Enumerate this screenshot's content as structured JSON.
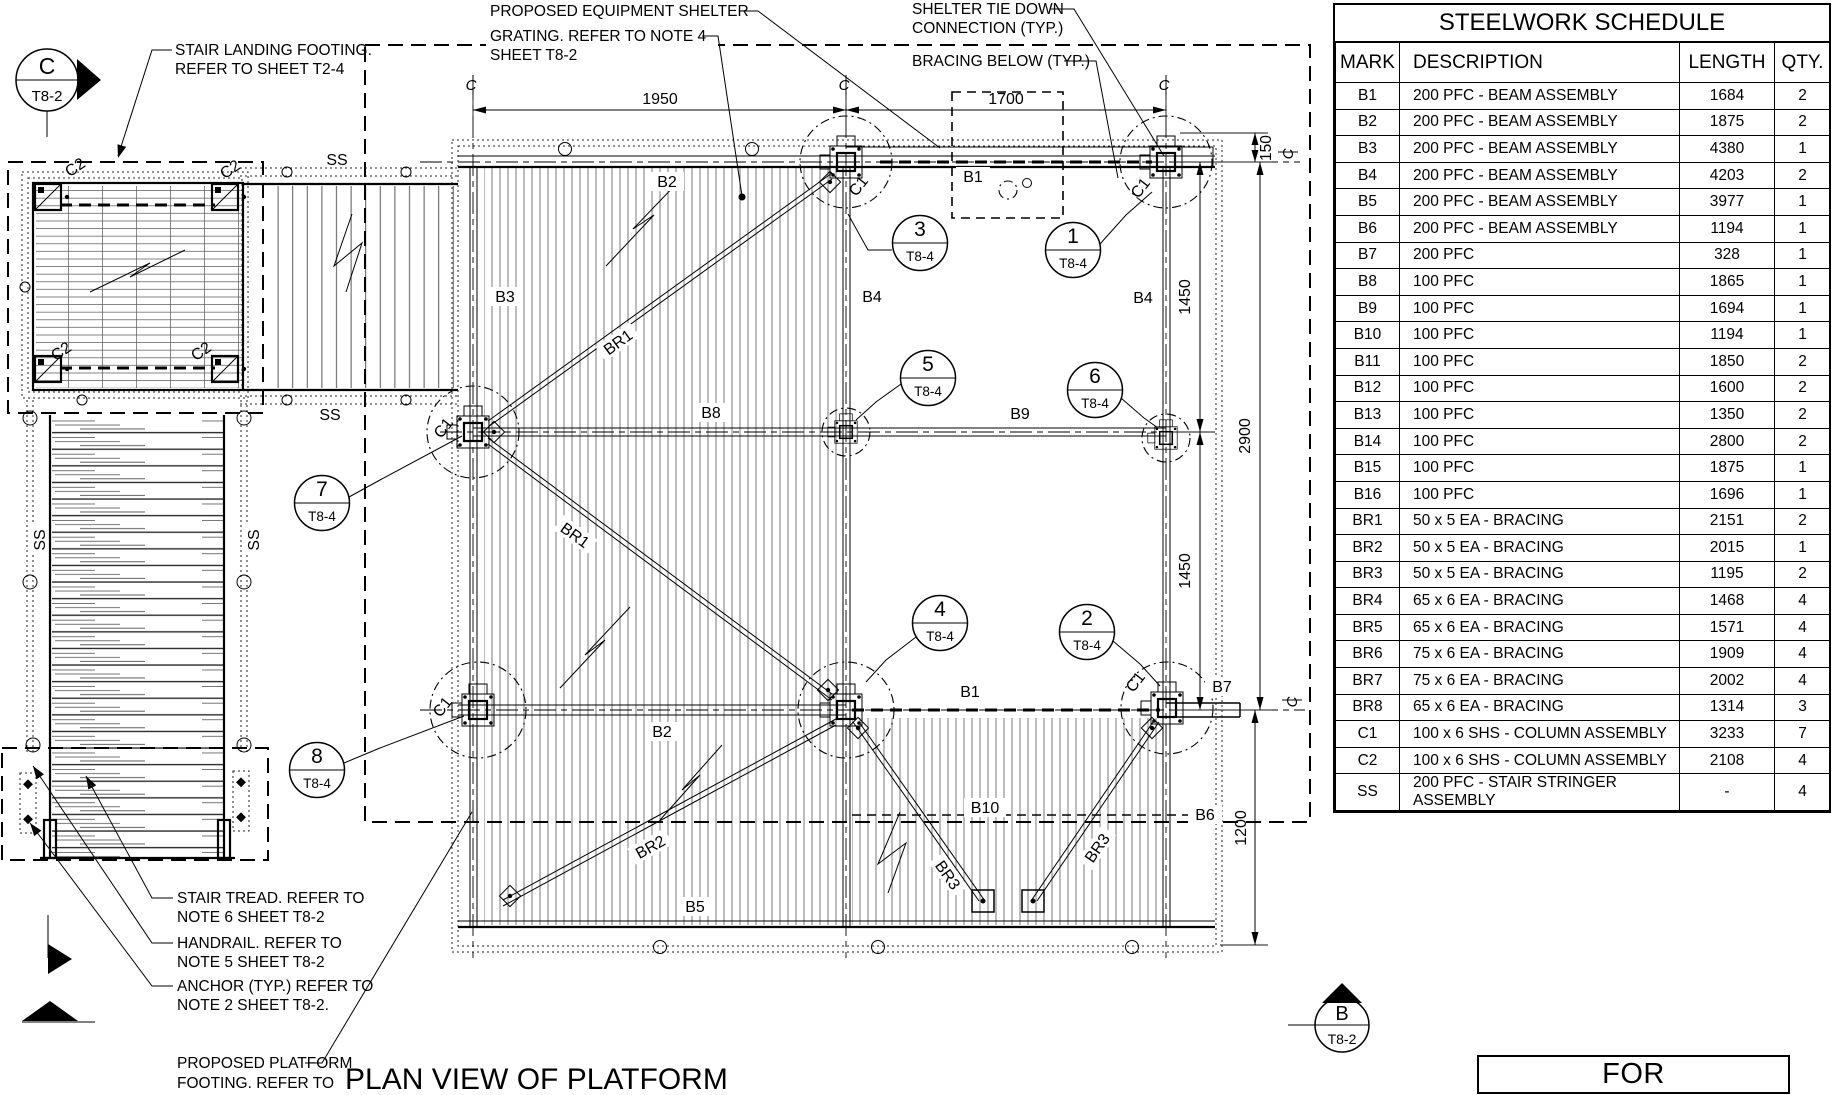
{
  "page": {
    "view_title": "PLAN VIEW OF PLATFORM",
    "stamp": "FOR CONSTRUCTION"
  },
  "schedule": {
    "title": "STEELWORK SCHEDULE",
    "columns": [
      "MARK",
      "DESCRIPTION",
      "LENGTH",
      "QTY."
    ],
    "rows": [
      [
        "B1",
        "200 PFC - BEAM ASSEMBLY",
        "1684",
        "2"
      ],
      [
        "B2",
        "200 PFC - BEAM ASSEMBLY",
        "1875",
        "2"
      ],
      [
        "B3",
        "200 PFC - BEAM ASSEMBLY",
        "4380",
        "1"
      ],
      [
        "B4",
        "200 PFC - BEAM ASSEMBLY",
        "4203",
        "2"
      ],
      [
        "B5",
        "200 PFC - BEAM ASSEMBLY",
        "3977",
        "1"
      ],
      [
        "B6",
        "200 PFC - BEAM ASSEMBLY",
        "1194",
        "1"
      ],
      [
        "B7",
        "200 PFC",
        "328",
        "1"
      ],
      [
        "B8",
        "100 PFC",
        "1865",
        "1"
      ],
      [
        "B9",
        "100 PFC",
        "1694",
        "1"
      ],
      [
        "B10",
        "100 PFC",
        "1194",
        "1"
      ],
      [
        "B11",
        "100 PFC",
        "1850",
        "2"
      ],
      [
        "B12",
        "100 PFC",
        "1600",
        "2"
      ],
      [
        "B13",
        "100 PFC",
        "1350",
        "2"
      ],
      [
        "B14",
        "100 PFC",
        "2800",
        "2"
      ],
      [
        "B15",
        "100 PFC",
        "1875",
        "1"
      ],
      [
        "B16",
        "100 PFC",
        "1696",
        "1"
      ],
      [
        "BR1",
        "50 x 5 EA - BRACING",
        "2151",
        "2"
      ],
      [
        "BR2",
        "50 x 5 EA - BRACING",
        "2015",
        "1"
      ],
      [
        "BR3",
        "50 x 5 EA - BRACING",
        "1195",
        "2"
      ],
      [
        "BR4",
        "65 x 6 EA - BRACING",
        "1468",
        "4"
      ],
      [
        "BR5",
        "65 x 6 EA - BRACING",
        "1571",
        "4"
      ],
      [
        "BR6",
        "75 x 6 EA - BRACING",
        "1909",
        "4"
      ],
      [
        "BR7",
        "75 x 6 EA - BRACING",
        "2002",
        "4"
      ],
      [
        "BR8",
        "65 x 6 EA - BRACING",
        "1314",
        "3"
      ],
      [
        "C1",
        "100 x 6 SHS - COLUMN ASSEMBLY",
        "3233",
        "7"
      ],
      [
        "C2",
        "100 x 6 SHS - COLUMN ASSEMBLY",
        "2108",
        "4"
      ],
      [
        "SS",
        "200 PFC - STAIR STRINGER ASSEMBLY",
        "-",
        "4"
      ]
    ]
  },
  "markers": {
    "c_section": {
      "letter": "C",
      "sheet": "T8-2"
    },
    "b_section": {
      "letter": "B",
      "sheet": "T8-2"
    }
  },
  "callouts": [
    {
      "num": "3",
      "sheet": "T8-4"
    },
    {
      "num": "1",
      "sheet": "T8-4"
    },
    {
      "num": "5",
      "sheet": "T8-4"
    },
    {
      "num": "6",
      "sheet": "T8-4"
    },
    {
      "num": "7",
      "sheet": "T8-4"
    },
    {
      "num": "8",
      "sheet": "T8-4"
    },
    {
      "num": "4",
      "sheet": "T8-4"
    },
    {
      "num": "2",
      "sheet": "T8-4"
    }
  ],
  "dims": {
    "w_left": "1950",
    "w_right": "1700",
    "h_150": "150",
    "h_1450a": "1450",
    "h_2900": "2900",
    "h_1450b": "1450",
    "h_1200": "1200"
  },
  "labels": {
    "b1": "B1",
    "b2": "B2",
    "b3": "B3",
    "b4": "B4",
    "b5": "B5",
    "b6": "B6",
    "b7": "B7",
    "b8": "B8",
    "b9": "B9",
    "b10": "B10",
    "br1": "BR1",
    "br2": "BR2",
    "br3": "BR3",
    "c1": "C1",
    "c2": "C2",
    "ss": "SS",
    "centerline": "C"
  },
  "notes": {
    "equipment_shelter": "PROPOSED EQUIPMENT SHELTER",
    "grating_1": "GRATING. REFER TO NOTE 4",
    "grating_2": "SHEET T8-2",
    "tie_down_1": "SHELTER TIE DOWN",
    "tie_down_2": "CONNECTION (TYP.)",
    "bracing_below": "BRACING BELOW (TYP.)",
    "stair_landing_1": "STAIR LANDING FOOTING.",
    "stair_landing_2": "REFER TO SHEET T2-4",
    "stair_tread_1": "STAIR TREAD. REFER TO",
    "stair_tread_2": "NOTE 6 SHEET T8-2",
    "handrail_1": "HANDRAIL. REFER TO",
    "handrail_2": "NOTE 5 SHEET T8-2",
    "anchor_1": "ANCHOR (TYP.) REFER TO",
    "anchor_2": "NOTE 2 SHEET T8-2.",
    "footing_1": "PROPOSED PLATFORM",
    "footing_2": "FOOTING. REFER TO"
  }
}
